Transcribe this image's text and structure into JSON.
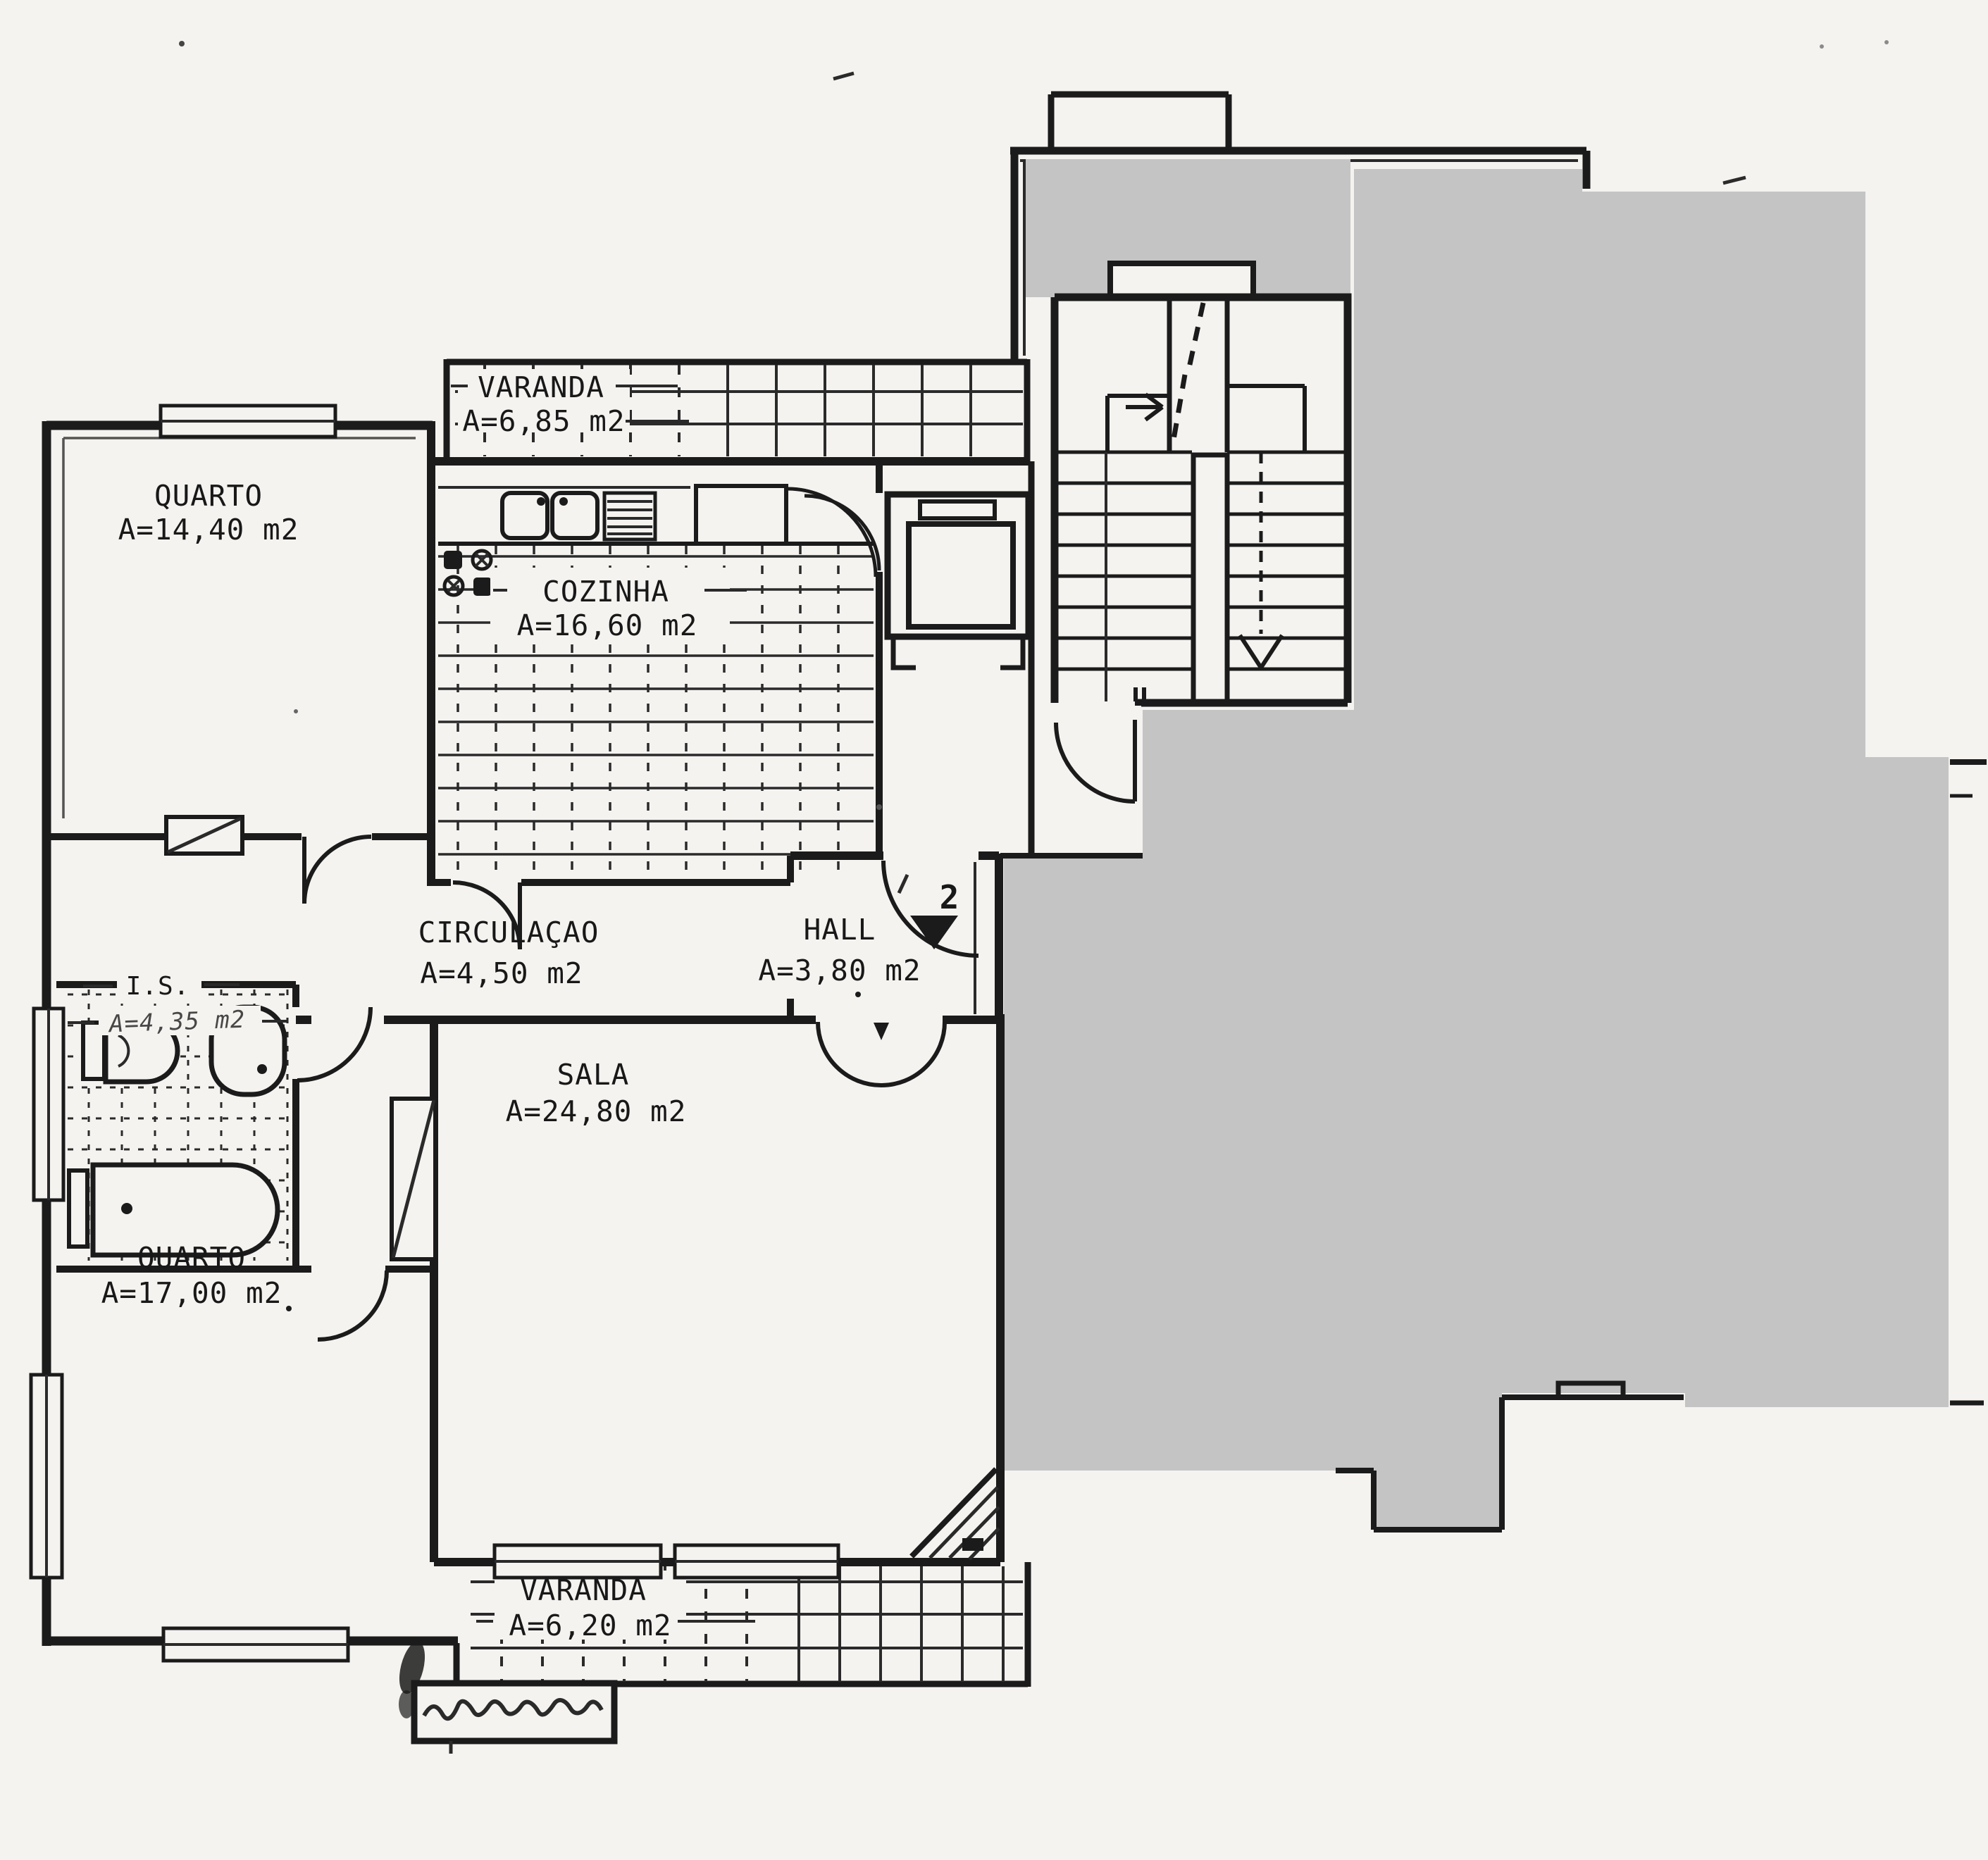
{
  "page": {
    "background_color": "#f5f3f0",
    "mask_color": "#c4c4c4",
    "ink_color": "#1b1b1b"
  },
  "plan": {
    "rooms": [
      {
        "name": "QUARTO",
        "area": "A=14,40 m2"
      },
      {
        "name": "VARANDA",
        "area": "A=6,85 m2"
      },
      {
        "name": "COZINHA",
        "area": "A=16,60 m2"
      },
      {
        "name": "CIRCULAÇAO",
        "area": "A=4,50 m2"
      },
      {
        "name": "HALL",
        "area": "A=3,80 m2"
      },
      {
        "name": "I.S.",
        "area": "A=4,35 m2"
      },
      {
        "name": "SALA",
        "area": "A=24,80 m2"
      },
      {
        "name": "QUARTO",
        "area": "A=17,00 m2"
      },
      {
        "name": "VARANDA",
        "area": "A=6,20 m2"
      }
    ],
    "entrance": {
      "unit_number": "2"
    }
  }
}
